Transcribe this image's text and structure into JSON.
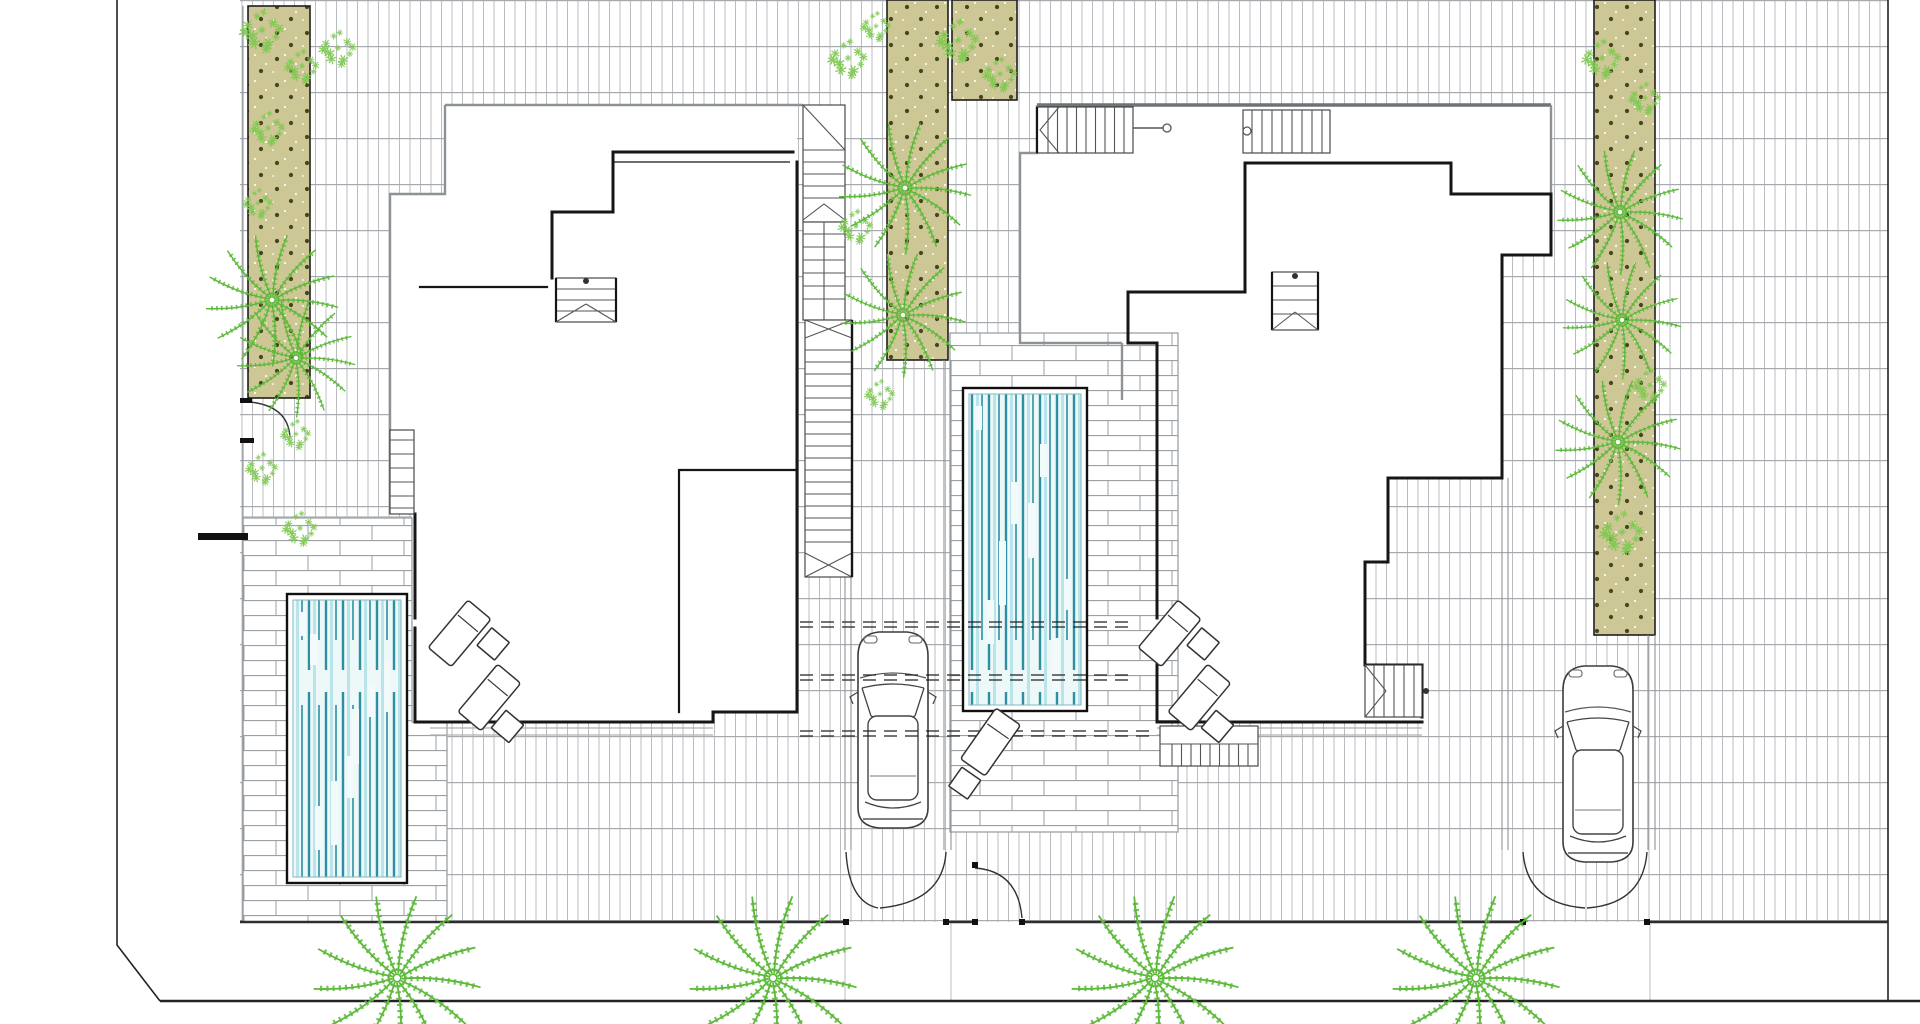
{
  "document": {
    "type": "architectural-site-plan",
    "title": "Twin villas site plan — pools, decks, driveways and palm planting",
    "visible_text_items": []
  },
  "colors": {
    "wall": "#161616",
    "roof_edge": "#8d9296",
    "roof_edge_heavy": "#6e7377",
    "planting_fill": "#cdc795",
    "planting_dot": "#45451f",
    "palm_green": "#5cb83a",
    "shrub_green": "#7cc94f",
    "water_bg": "#edf8f9",
    "water_dark": "#2e8fa3",
    "water_light": "#b9e4e9",
    "tile_line": "#b9bdc0",
    "deck_line": "#9aa0a4",
    "boundary": "#222222"
  },
  "site": {
    "planting_strips": [
      {
        "id": "strip-left",
        "x": 248,
        "y": 6,
        "w": 62,
        "h": 392
      },
      {
        "id": "strip-middle",
        "x": 887,
        "y": 0,
        "w": 61,
        "h": 360
      },
      {
        "id": "strip-right",
        "x": 1594,
        "y": 0,
        "w": 61,
        "h": 635
      },
      {
        "id": "bed-top",
        "x": 952,
        "y": 0,
        "w": 65,
        "h": 100
      }
    ],
    "pools": [
      {
        "id": "pool-1",
        "x": 287,
        "y": 594,
        "w": 120,
        "h": 289
      },
      {
        "id": "pool-2",
        "x": 963,
        "y": 388,
        "w": 124,
        "h": 323
      }
    ],
    "decks": [
      {
        "id": "deck-1",
        "path": "M243,518 H412 V722 H447 V922 H243 Z"
      },
      {
        "id": "deck-2",
        "x": 950,
        "y": 333,
        "w": 228,
        "h": 499
      }
    ],
    "cars": [
      {
        "id": "car-1",
        "x": 851,
        "y": 626
      },
      {
        "id": "car-2",
        "x": 1556,
        "y": 660
      }
    ],
    "street_palms": [
      [
        397,
        978,
        1.2
      ],
      [
        773,
        978,
        1.2
      ],
      [
        1155,
        978,
        1.2
      ],
      [
        1476,
        978,
        1.2
      ]
    ],
    "strip_palms": [
      [
        272,
        300,
        0.95
      ],
      [
        296,
        358,
        0.85
      ],
      [
        905,
        188,
        0.95
      ],
      [
        903,
        315,
        0.9
      ],
      [
        1620,
        212,
        0.9
      ],
      [
        1622,
        320,
        0.85
      ],
      [
        1618,
        442,
        0.9
      ]
    ],
    "shrubs": [
      [
        262,
        30,
        1
      ],
      [
        302,
        66,
        0.8
      ],
      [
        338,
        48,
        0.85
      ],
      [
        268,
        128,
        0.8
      ],
      [
        258,
        203,
        0.7
      ],
      [
        262,
        468,
        0.75
      ],
      [
        300,
        528,
        0.8
      ],
      [
        296,
        434,
        0.7
      ],
      [
        848,
        58,
        0.9
      ],
      [
        876,
        26,
        0.7
      ],
      [
        958,
        40,
        1
      ],
      [
        1000,
        74,
        0.8
      ],
      [
        856,
        226,
        0.8
      ],
      [
        880,
        394,
        0.7
      ],
      [
        1602,
        58,
        0.9
      ],
      [
        1645,
        98,
        0.75
      ],
      [
        1650,
        385,
        0.8
      ],
      [
        1622,
        532,
        1
      ]
    ],
    "lounger_groups": [
      {
        "id": "loungers-villa-1",
        "x": 468,
        "y": 600,
        "rot": 40,
        "items": [
          {
            "t": "chaise",
            "x": 0,
            "y": 0
          },
          {
            "t": "table",
            "x": 36,
            "y": 6
          },
          {
            "t": "chaise",
            "x": 64,
            "y": 30
          },
          {
            "t": "table",
            "x": 100,
            "y": 60
          }
        ]
      },
      {
        "id": "loungers-villa-2",
        "x": 1178,
        "y": 600,
        "rot": 40,
        "items": [
          {
            "t": "chaise",
            "x": 0,
            "y": 0
          },
          {
            "t": "table",
            "x": 36,
            "y": 6
          },
          {
            "t": "chaise",
            "x": 64,
            "y": 30
          },
          {
            "t": "table",
            "x": 100,
            "y": 60
          }
        ]
      },
      {
        "id": "lounger-deck-2",
        "x": 996,
        "y": 708,
        "rot": 35,
        "items": [
          {
            "t": "chaise",
            "x": 0,
            "y": 0
          },
          {
            "t": "table",
            "x": 6,
            "y": 68
          }
        ]
      }
    ]
  }
}
